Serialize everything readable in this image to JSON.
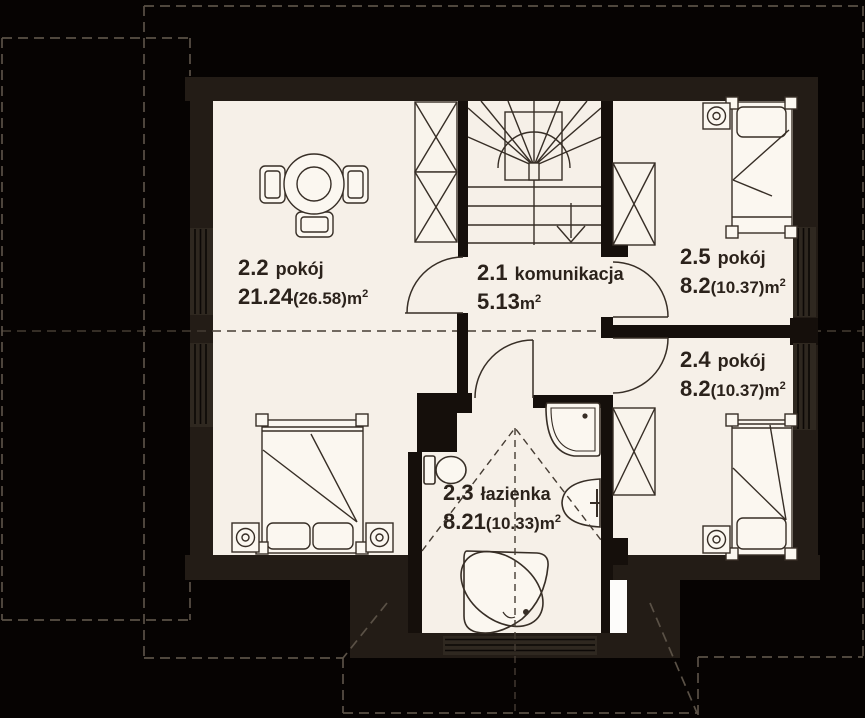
{
  "plan_type": "floor-plan",
  "colors": {
    "background": "#060302",
    "perimeter_wall": "#231c16",
    "interior_wall": "#150f0b",
    "floor": "#f6f0e8",
    "furniture_fill": "#fbf7f0",
    "furniture_stroke": "#372e26",
    "roof_dash": "#5a5146",
    "interior_dash": "#453c33",
    "text": "#2b221b",
    "window_glass": "#2f2820",
    "chimney_white": "#fdfcfa"
  },
  "rooms": {
    "r21": {
      "number": "2.1",
      "name": "komunikacja",
      "area": "5.13",
      "area_alt": "",
      "unit": "m",
      "sup": "2"
    },
    "r22": {
      "number": "2.2",
      "name": "pokój",
      "area": "21.24",
      "area_alt": "(26.58)",
      "unit": "m",
      "sup": "2"
    },
    "r23": {
      "number": "2.3",
      "name": "łazienka",
      "area": "8.21",
      "area_alt": "(10.33)",
      "unit": "m",
      "sup": "2"
    },
    "r24": {
      "number": "2.4",
      "name": "pokój",
      "area": "8.2",
      "area_alt": "(10.37)",
      "unit": "m",
      "sup": "2"
    },
    "r25": {
      "number": "2.5",
      "name": "pokój",
      "area": "8.2",
      "area_alt": "(10.37)",
      "unit": "m",
      "sup": "2"
    }
  }
}
